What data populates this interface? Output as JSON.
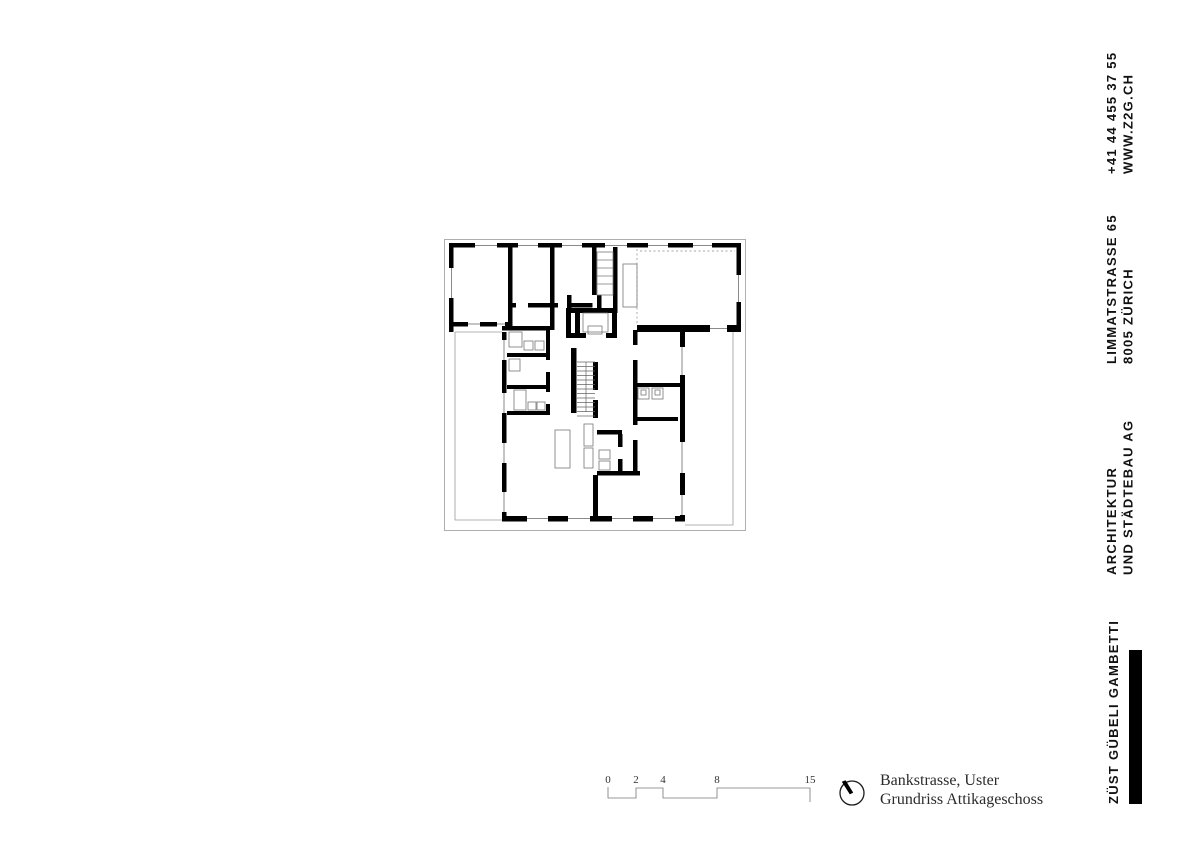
{
  "contact": {
    "phone": "+41 44 455 37 55",
    "website": "WWW.Z2G.CH"
  },
  "address": {
    "line1": "LIMMATSTRASSE 65",
    "line2": "8005 ZÜRICH"
  },
  "firm": {
    "line1": "ARCHITEKTUR",
    "line2": "UND STÄDTEBAU AG",
    "name": "ZÜST GÜBELI GAMBETTI"
  },
  "title_block": {
    "project": "Bankstrasse, Uster",
    "drawing": "Grundriss Attikageschoss"
  },
  "scale_bar": {
    "labels": [
      "0",
      "2",
      "4",
      "8",
      "15"
    ]
  },
  "icons": {
    "north_arrow": "north-arrow"
  },
  "colors": {
    "wall": "#000000",
    "thin_line": "#9b9b9b",
    "text": "#111111",
    "accent_bar": "#000000"
  }
}
